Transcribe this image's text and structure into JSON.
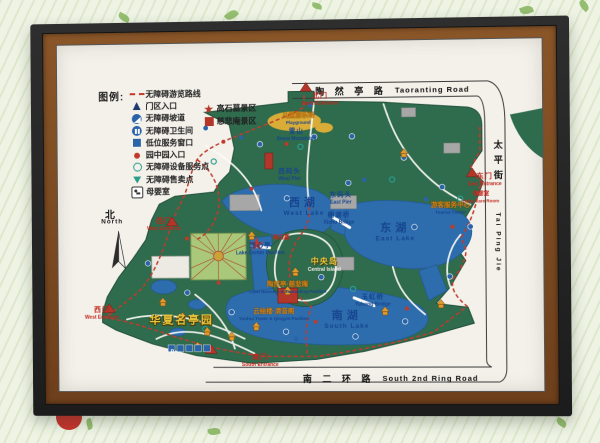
{
  "colors": {
    "frame_outer": "#1f1f1f",
    "frame_inner_brown": "#7a4a22",
    "paper": "#f3f1ea",
    "park_green": "#2f6b4d",
    "water_blue": "#2d6dad",
    "route_red": "#c23a2c",
    "entrance_red": "#c0271d",
    "label_blue": "#16458f",
    "pavilion_orange": "#d98e2b",
    "background": "#eef3e4"
  },
  "legend": {
    "title": "图例:",
    "items": [
      {
        "icon": "red-dashed-route",
        "label": "无障碍游览路线"
      },
      {
        "icon": "navy-triangle-gate",
        "label": "门区入口"
      },
      {
        "icon": "wheelchair-ramp-circle",
        "label": "无障碍坡道"
      },
      {
        "icon": "accessible-toilet-circle",
        "label": "无障碍卫生间"
      },
      {
        "icon": "blue-square-window",
        "label": "低位服务窗口"
      },
      {
        "icon": "red-dot-garden-entry",
        "label": "园中园入口"
      },
      {
        "icon": "teal-ring-service",
        "label": "无障碍设备服务点"
      },
      {
        "icon": "teal-triangle-kiosk",
        "label": "无障碍售卖点"
      },
      {
        "icon": "baby-room-box",
        "label": "母婴室"
      }
    ],
    "areas": [
      {
        "icon": "red-star",
        "label": "高石墓景区"
      },
      {
        "icon": "red-square",
        "label": "慈悲庵景区"
      }
    ]
  },
  "compass": {
    "zh": "北",
    "en": "North"
  },
  "roads": {
    "top": {
      "zh": "陶 然 亭 路",
      "en": "Taoranting Road"
    },
    "right": {
      "zh": "太平街",
      "en": "Tai Ping Jie"
    },
    "bottom": {
      "zh": "南 二 环 路",
      "en": "South 2nd Ring Road"
    }
  },
  "lakes": {
    "west": {
      "zh": "西湖",
      "en": "West Lake"
    },
    "east": {
      "zh": "东湖",
      "en": "East Lake"
    },
    "south": {
      "zh": "南湖",
      "en": "South Lake"
    }
  },
  "entrances": {
    "north": {
      "zh": "北门",
      "en": "North Entrance"
    },
    "east": {
      "zh": "东门",
      "en": "East Entrance"
    },
    "south": {
      "zh": "南门",
      "en": "South Entrance"
    },
    "west_upper": {
      "zh": "西门",
      "en": "West Entrance"
    },
    "west_lower": {
      "zh": "西门",
      "en": "West Entrance"
    }
  },
  "features": {
    "east_pier": {
      "zh": "东码头",
      "en": "East Pier"
    },
    "west_pier": {
      "zh": "西码头",
      "en": "West Pier"
    },
    "xiehu_bridge": {
      "zh": "榭湖桥",
      "en": "Xiehu Bridge"
    },
    "yuhong_bridge": {
      "zh": "玉虹桥",
      "en": "Yuhong Bridge"
    },
    "lake_center_pavilion": {
      "zh": "湖心亭",
      "en": "Lake Center Pavilion"
    },
    "snow_mountains": {
      "zh": "雪山",
      "en": "Snow Mountains"
    },
    "playground": {
      "zh": "儿童游乐场",
      "en": "Playground"
    },
    "central_island": {
      "zh": "中央岛",
      "en": "Central Island"
    },
    "huaxia_pavilion_garden": {
      "zh": "华夏名亭园"
    },
    "taoranting_cibeian": {
      "zh": "陶然亭·慈悲庵",
      "en": "Cibei Nunnery & Taoranting Pavilion"
    },
    "yunhui_qingyin": {
      "zh": "云绘楼·清音阁",
      "en": "Yunhui Tower & Qingyin Pavilion"
    },
    "gaoshi_tomb": {
      "zh": "高石墓"
    },
    "baby_care_room": {
      "zh": "母婴室",
      "en": "Baby Care Room"
    },
    "tourist_center": {
      "zh": "游客服务中心",
      "en": "Tourist Center"
    },
    "parking": {
      "label": "P"
    }
  }
}
